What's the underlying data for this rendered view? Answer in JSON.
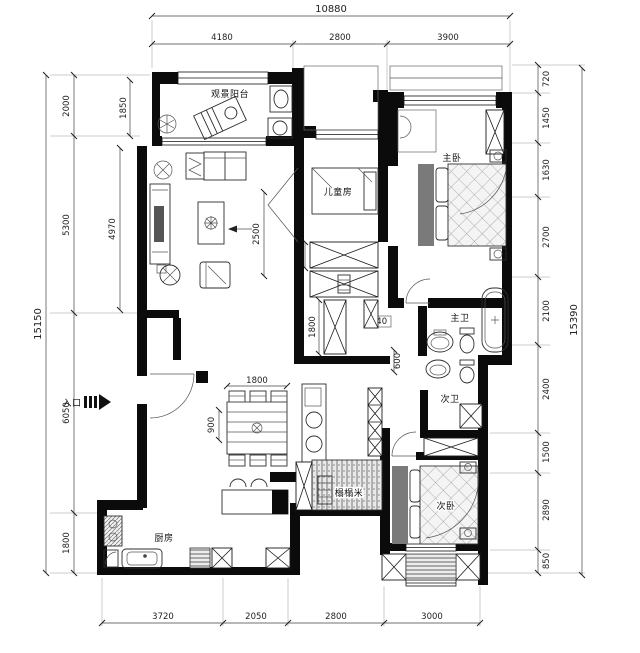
{
  "rooms": {
    "balcony": "观景阳台",
    "kids_room": "儿童房",
    "master_bedroom": "主卧",
    "master_bath": "主卫",
    "second_bath": "次卫",
    "second_bedroom": "次卧",
    "kitchen": "厨房",
    "tatami": "榻榻米",
    "entrance": "入口"
  },
  "dims": {
    "top_total": "10880",
    "top": [
      "4180",
      "2800",
      "3900"
    ],
    "left_total": "15150",
    "left": [
      "2000",
      "5300",
      "6050",
      "1800"
    ],
    "left_inner": [
      "1850",
      "4970"
    ],
    "right": [
      "720",
      "1450",
      "1630",
      "2700",
      "2100",
      "2400",
      "1500",
      "2890",
      "850"
    ],
    "right_total": "15390",
    "bottom": [
      "3720",
      "2050",
      "2800",
      "3000"
    ],
    "living_width": "2500",
    "closet": [
      "600",
      "773",
      "550",
      "540",
      "1800",
      "600"
    ],
    "dining": [
      "1800",
      "900"
    ]
  }
}
